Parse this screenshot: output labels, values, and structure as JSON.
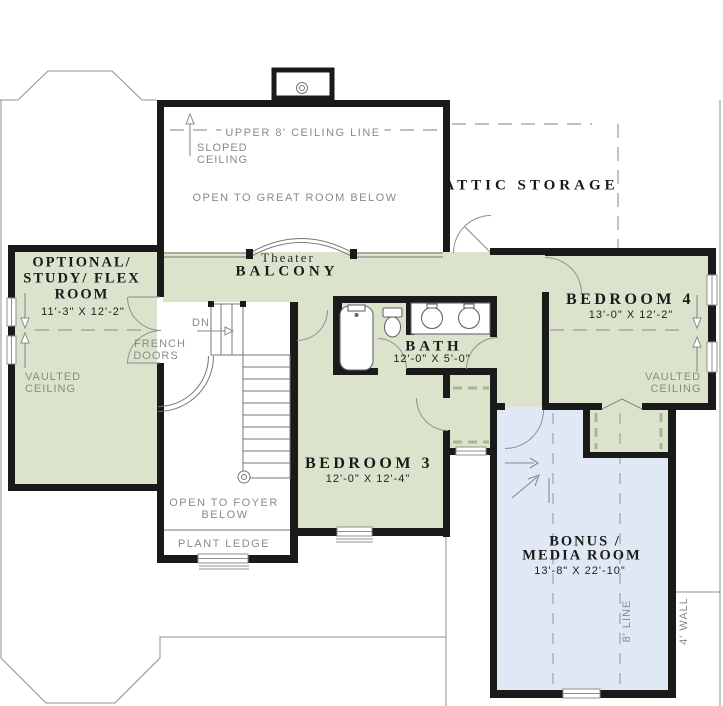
{
  "theme": {
    "wall_color": "#1a1a1a",
    "room_green": "#dbe3cc",
    "room_blue": "#dfe8f4",
    "line_gray": "#8f8f8f",
    "label_gray": "#8a8a8a",
    "dim_color": "#1f1f1f"
  },
  "plan": {
    "great_room": {
      "ceiling_line": "UPPER 8' CEILING LINE",
      "sloped_1": "SLOPED",
      "sloped_2": "CEILING",
      "open_below": "OPEN TO GREAT ROOM BELOW"
    },
    "attic": {
      "label": "ATTIC STORAGE"
    },
    "balcony": {
      "pre": "Theater",
      "label": "BALCONY"
    },
    "flex_room": {
      "name_1": "OPTIONAL/",
      "name_2": "STUDY/ FLEX",
      "name_3": "ROOM",
      "dims": "11'-3\" X 12'-2\"",
      "vaulted_1": "VAULTED",
      "vaulted_2": "CEILING"
    },
    "french_doors": {
      "label_1": "FRENCH",
      "label_2": "DOORS"
    },
    "stairs": {
      "dn": "DN"
    },
    "bath": {
      "name": "BATH",
      "dims": "12'-0\" X 5'-0\""
    },
    "bedroom3": {
      "name": "BEDROOM 3",
      "dims": "12'-0\" X 12'-4\""
    },
    "bedroom4": {
      "name": "BEDROOM 4",
      "dims": "13'-0\" X 12'-2\"",
      "vaulted_1": "VAULTED",
      "vaulted_2": "CEILING"
    },
    "foyer": {
      "open_1": "OPEN TO FOYER",
      "open_2": "BELOW",
      "plant_ledge": "PLANT LEDGE"
    },
    "bonus": {
      "name_1": "BONUS /",
      "name_2": "MEDIA ROOM",
      "dims": "13'-8\" X 22'-10\"",
      "line_8": "8' LINE",
      "wall_4": "4' WALL"
    }
  }
}
